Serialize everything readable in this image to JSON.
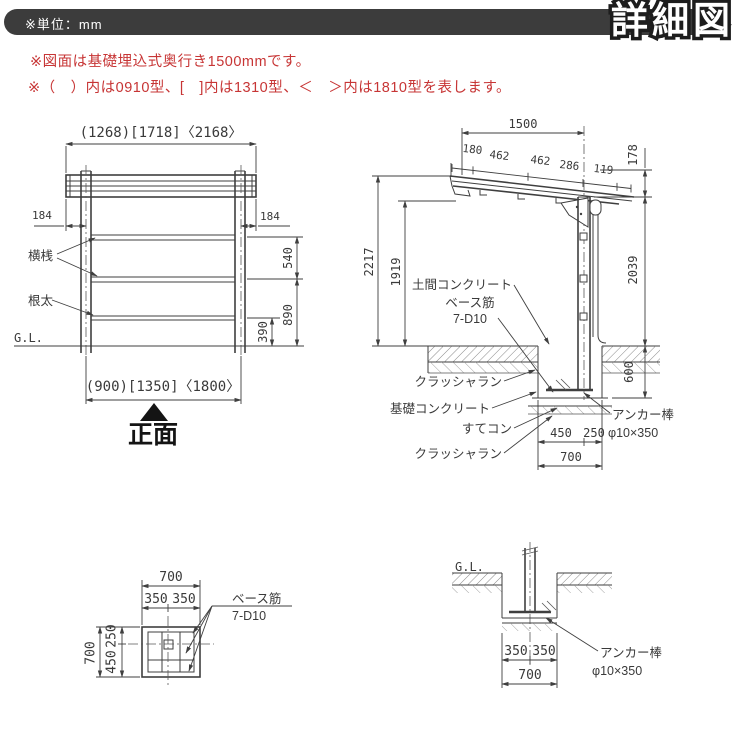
{
  "header": {
    "unit_note": "※単位：mm",
    "title": "詳細図"
  },
  "notes": {
    "line1": "※図面は基礎埋込式奥行き1500mmです。",
    "line2": "※（　）内は0910型、[　]内は1310型、＜　＞内は1810型を表します。"
  },
  "colors": {
    "header_bar": "#3c3c3c",
    "note_red": "#c73535",
    "line": "#3f3f3f"
  },
  "front": {
    "dim_top": "(1268)[1718]〈2168〉",
    "dim_184_left": "184",
    "dim_184_right": "184",
    "label_yokosan": "横桟",
    "label_neda": "根太",
    "dim_540": "540",
    "dim_890": "890",
    "dim_390": "390",
    "label_gl": "G.L.",
    "dim_bottom": "(900)[1350]〈1800〉",
    "caption": "正面"
  },
  "side": {
    "dim_1500": "1500",
    "slope": [
      "180",
      "462",
      "462",
      "286",
      "119"
    ],
    "dim_178": "178",
    "dim_2217": "2217",
    "dim_1919": "1919",
    "dim_2039": "2039",
    "dim_600": "600",
    "label_doma": "土間コンクリート",
    "label_base1": "ベース筋",
    "label_base2": "7-D10",
    "label_crusher1": "クラッシャラン",
    "label_foundation": "基礎コンクリート",
    "label_sutekon": "すてコン",
    "label_crusher2": "クラッシャラン",
    "label_anchor1": "アンカー棒",
    "label_anchor2": "φ10×350",
    "dim_450": "450",
    "dim_250": "250",
    "dim_700": "700"
  },
  "plan": {
    "dim_700_top": "700",
    "dim_350a": "350",
    "dim_350b": "350",
    "dim_700_left": "700",
    "dim_250": "250",
    "dim_450": "450",
    "label_base1": "ベース筋",
    "label_base2": "7-D10"
  },
  "section": {
    "label_gl": "G.L.",
    "dim_350a": "350",
    "dim_350b": "350",
    "dim_700": "700",
    "label_anchor1": "アンカー棒",
    "label_anchor2": "φ10×350"
  }
}
